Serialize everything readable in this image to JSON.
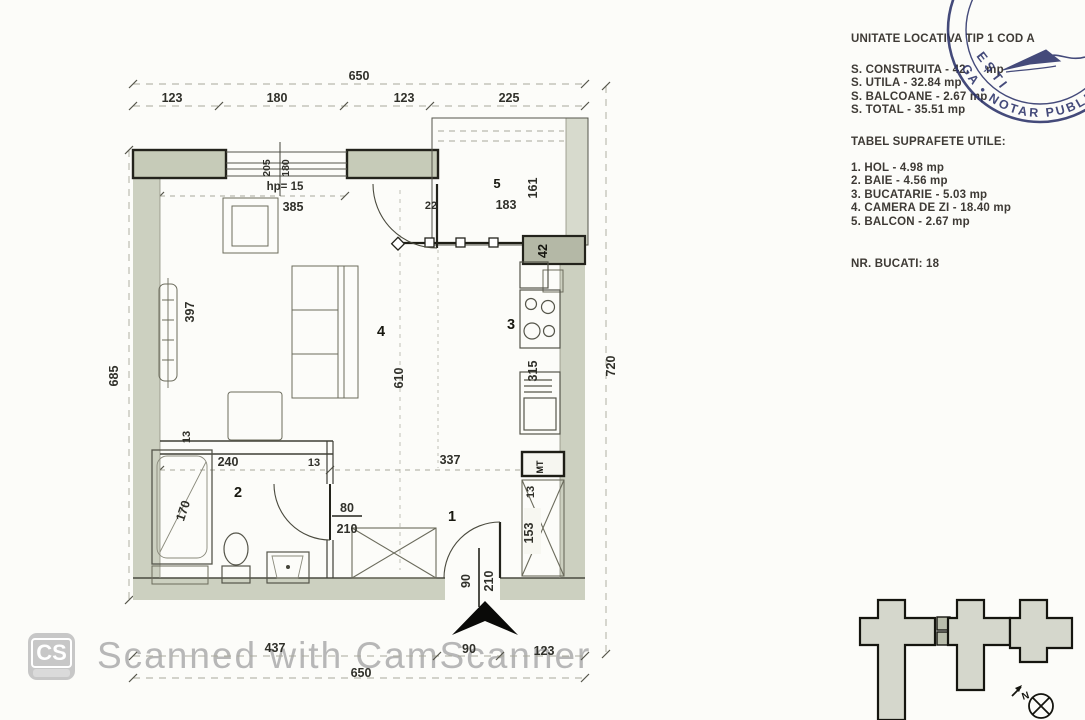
{
  "plan": {
    "dims": {
      "top_total": "650",
      "top_a": "123",
      "top_b": "180",
      "top_c": "123",
      "top_d": "225",
      "win_h1": "205",
      "win_h2": "180",
      "hp": "hp= 15",
      "win_w": "385",
      "left_total": "685",
      "left_397": "397",
      "right_total": "720",
      "bottom_a": "437",
      "bottom_b": "90",
      "bottom_c": "123",
      "bottom_total": "650"
    },
    "rooms": {
      "hall": {
        "num": "1",
        "d337": "337",
        "d13": "13",
        "d153": "153",
        "entry_w": "90",
        "entry_h": "210",
        "meter": "MT"
      },
      "bath": {
        "num": "2",
        "d13a": "13",
        "d240": "240",
        "d13b": "13",
        "d170": "170",
        "door_w": "80",
        "door_h": "210"
      },
      "kitchen": {
        "num": "3",
        "d315": "315"
      },
      "living": {
        "num": "4",
        "d610": "610"
      },
      "balcony": {
        "num": "5",
        "d161": "161",
        "d183": "183",
        "d22": "22",
        "d42": "42"
      }
    }
  },
  "panel": {
    "title": "UNITATE LOCATIVA TIP 1 COD A",
    "area_construita": "S. CONSTRUITA - 42.     mp",
    "area_utila": "S. UTILA - 32.84 mp",
    "area_balcoane": "S. BALCOANE - 2.67 mp",
    "area_total": "S. TOTAL - 35.51 mp",
    "tabel_heading": "TABEL SUPRAFETE UTILE:",
    "tabel_items": [
      "1. HOL - 4.98 mp",
      "2. BAIE - 4.56 mp",
      "3. BUCATARIE - 5.03 mp",
      "4. CAMERA DE ZI - 18.40 mp",
      "5. BALCON - 2.67 mp"
    ],
    "nr_bucati": "NR. BUCATI: 18"
  },
  "stamp": {
    "ring_text": "GA • NOTAR PUBLIC • A",
    "diagonal_text": "EȘTI"
  },
  "site_plan": {
    "compass_label": "N"
  },
  "watermark": {
    "logo": "CS",
    "text": "Scanned with CamScanner"
  },
  "colors": {
    "paper": "#fcfcf9",
    "wall_fill": "#ccd0c0",
    "ink": "#23231c",
    "stamp_ink": "#2b3269",
    "watermark_gray": "#b7b7b7"
  }
}
